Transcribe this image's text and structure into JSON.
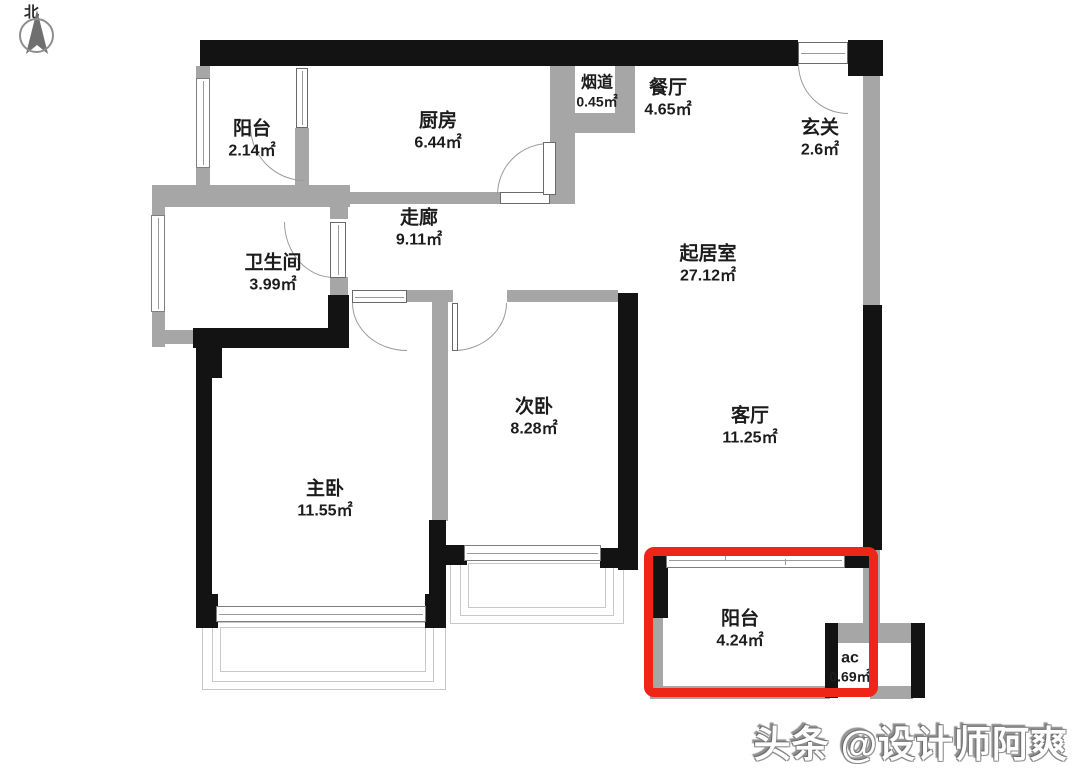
{
  "compass": {
    "label": "北"
  },
  "watermark": {
    "text": "头条 @设计师阿爽"
  },
  "highlight": {
    "color": "#ee2517",
    "target": "阳台 4.24㎡"
  },
  "colors": {
    "structural_wall": "#131313",
    "partition_wall": "#a6a6a6",
    "background": "#ffffff"
  },
  "rooms": [
    {
      "id": "balcony-top",
      "name": "阳台",
      "area": "2.14㎡"
    },
    {
      "id": "kitchen",
      "name": "厨房",
      "area": "6.44㎡"
    },
    {
      "id": "flue",
      "name": "烟道",
      "area": "0.45㎡"
    },
    {
      "id": "dining-room",
      "name": "餐厅",
      "area": "4.65㎡"
    },
    {
      "id": "entry-hall",
      "name": "玄关",
      "area": "2.6㎡"
    },
    {
      "id": "corridor",
      "name": "走廊",
      "area": "9.11㎡"
    },
    {
      "id": "bathroom",
      "name": "卫生间",
      "area": "3.99㎡"
    },
    {
      "id": "living-area",
      "name": "起居室",
      "area": "27.12㎡"
    },
    {
      "id": "second-bedroom",
      "name": "次卧",
      "area": "8.28㎡"
    },
    {
      "id": "living-room",
      "name": "客厅",
      "area": "11.25㎡"
    },
    {
      "id": "master-bedroom",
      "name": "主卧",
      "area": "11.55㎡"
    },
    {
      "id": "balcony-bottom",
      "name": "阳台",
      "area": "4.24㎡"
    },
    {
      "id": "ac-platform",
      "name": "ac",
      "area": "0.69㎡"
    }
  ]
}
